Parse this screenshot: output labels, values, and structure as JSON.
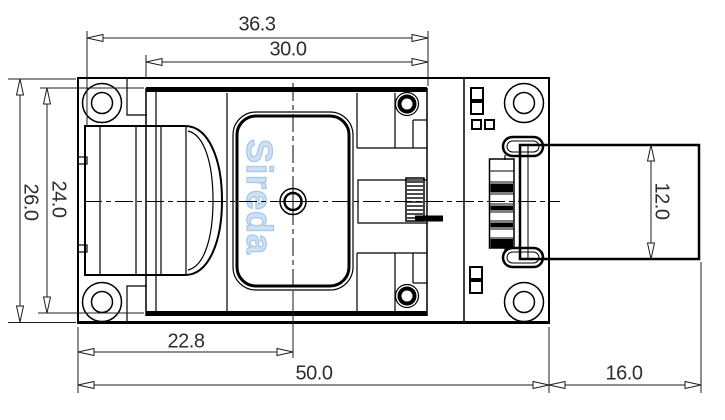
{
  "drawing": {
    "watermark": "Sireda",
    "dimensions": {
      "width_overall_top": "36.3",
      "width_inner_top": "30.0",
      "height_board": "26.0",
      "height_module": "24.0",
      "offset_antenna_center": "22.8",
      "width_board": "50.0",
      "length_connector": "16.0",
      "height_connector": "12.0"
    },
    "colors": {
      "line": "#000000",
      "dim_text": "#2e2e2e",
      "watermark": "#b9d3ee",
      "background": "#ffffff"
    }
  }
}
